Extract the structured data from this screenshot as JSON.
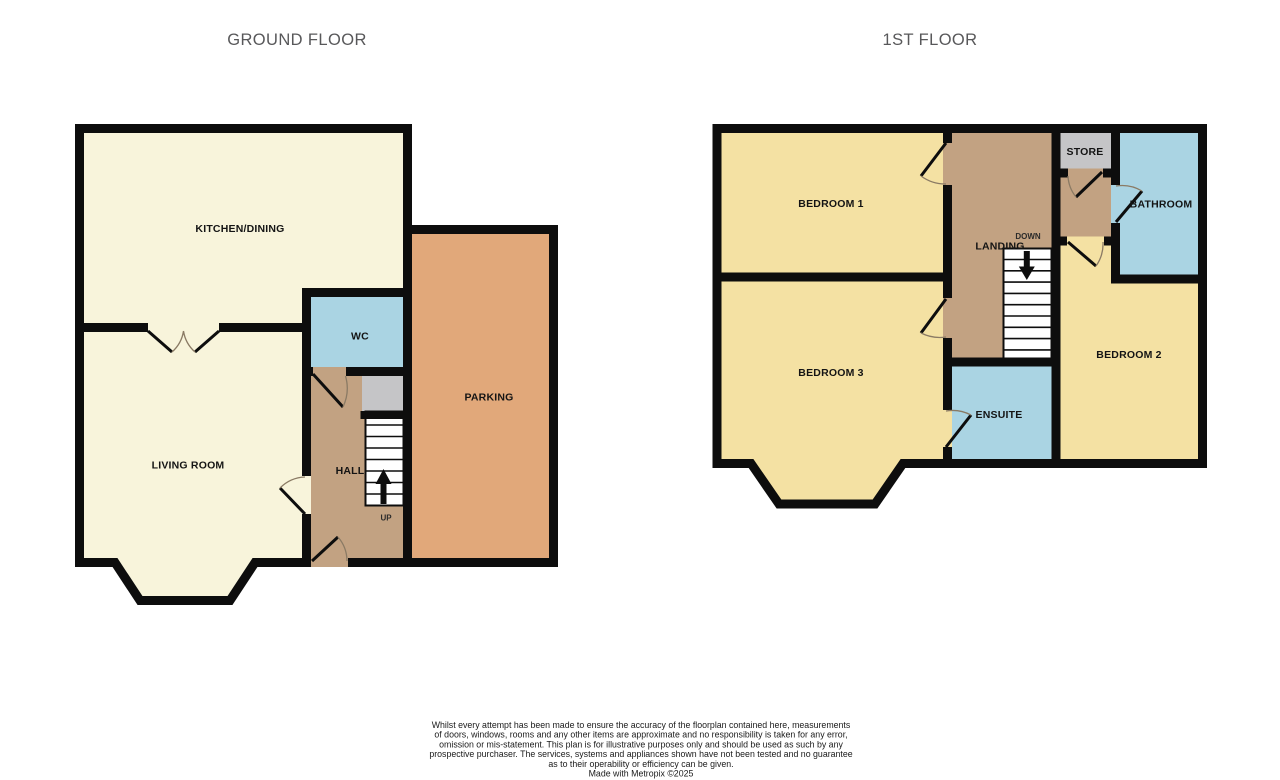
{
  "palette": {
    "floor_cream": "#f8f4db",
    "floor_yellow": "#f4e1a3",
    "floor_tan": "#c2a282",
    "floor_orange": "#e1a87a",
    "floor_blue": "#aad4e3",
    "floor_gray": "#c5c5c7",
    "wall_black": "#0d0d0d",
    "door_arc": "#8a7a64",
    "title_gray": "#58585a"
  },
  "titles": {
    "ground_floor": "GROUND FLOOR",
    "first_floor": "1ST FLOOR"
  },
  "ground_floor": {
    "kitchen_dining": {
      "label": "KITCHEN/DINING"
    },
    "living_room": {
      "label": "LIVING ROOM"
    },
    "wc": {
      "label": "WC"
    },
    "hall": {
      "label": "HALL"
    },
    "parking": {
      "label": "PARKING"
    },
    "stairs": {
      "label": "UP"
    }
  },
  "first_floor": {
    "bedroom_1": {
      "label": "BEDROOM 1"
    },
    "bedroom_2": {
      "label": "BEDROOM 2"
    },
    "bedroom_3": {
      "label": "BEDROOM 3"
    },
    "landing": {
      "label": "LANDING"
    },
    "store": {
      "label": "STORE"
    },
    "bathroom": {
      "label": "BATHROOM"
    },
    "ensuite": {
      "label": "ENSUITE"
    },
    "stairs": {
      "label": "DOWN"
    }
  },
  "disclaimer": {
    "lines": [
      "Whilst every attempt has been made to ensure the accuracy of the floorplan contained here, measurements",
      "of doors, windows, rooms and any other items are approximate and no responsibility is taken for any error,",
      "omission or mis-statement. This plan is for illustrative purposes only and should be used as such by any",
      "prospective purchaser. The services, systems and appliances shown have not been tested and no guarantee",
      "as to their operability or efficiency can be given.",
      "Made with Metropix ©2025"
    ]
  }
}
